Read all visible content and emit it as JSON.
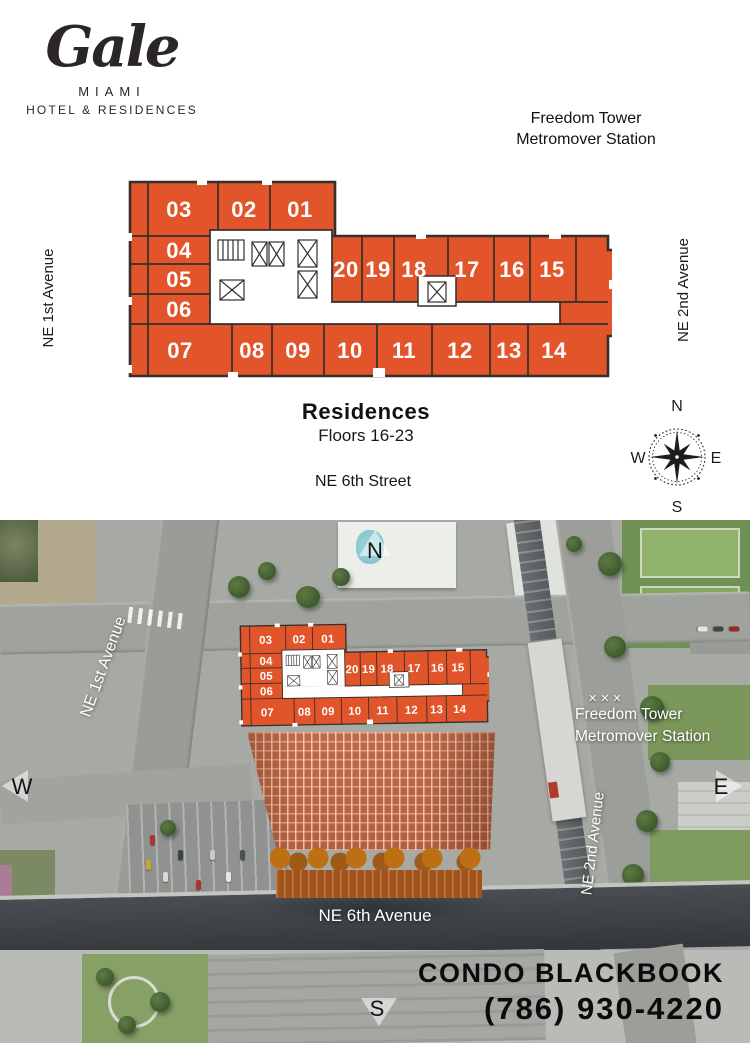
{
  "brand": {
    "logo_name": "Gale",
    "logo_city": "MIAMI",
    "logo_tagline": "HOTEL & RESIDENCES"
  },
  "keyplate": {
    "station_line1": "Freedom Tower",
    "station_line2": "Metromover Station",
    "street_left": "NE 1st Avenue",
    "street_right": "NE 2nd Avenue",
    "street_bottom": "NE 6th Street",
    "title": "Residences",
    "subtitle": "Floors 16-23",
    "units": [
      "03",
      "02",
      "01",
      "04",
      "05",
      "06",
      "20",
      "19",
      "18",
      "17",
      "16",
      "15",
      "07",
      "08",
      "09",
      "10",
      "11",
      "12",
      "13",
      "14"
    ],
    "compass": {
      "north": "N",
      "south": "S",
      "east": "E",
      "west": "W"
    }
  },
  "aerial": {
    "street_left": "NE 1st Avenue",
    "street_right": "NE 2nd Avenue",
    "street_bottom": "NE 6th Avenue",
    "station_line1": "Freedom Tower",
    "station_line2": "Metromover Station",
    "crossing_marks": "✕✕✕",
    "compass": {
      "north": "N",
      "south": "S",
      "east": "E",
      "west": "W"
    },
    "advertiser": "CONDO BLACKBOOK",
    "phone": "(786) 930-4220"
  },
  "colors": {
    "unit_orange": "#e2542a",
    "plan_outline": "#34302b",
    "tower_orange": "#b86345",
    "road_dark": "#3e4247"
  }
}
